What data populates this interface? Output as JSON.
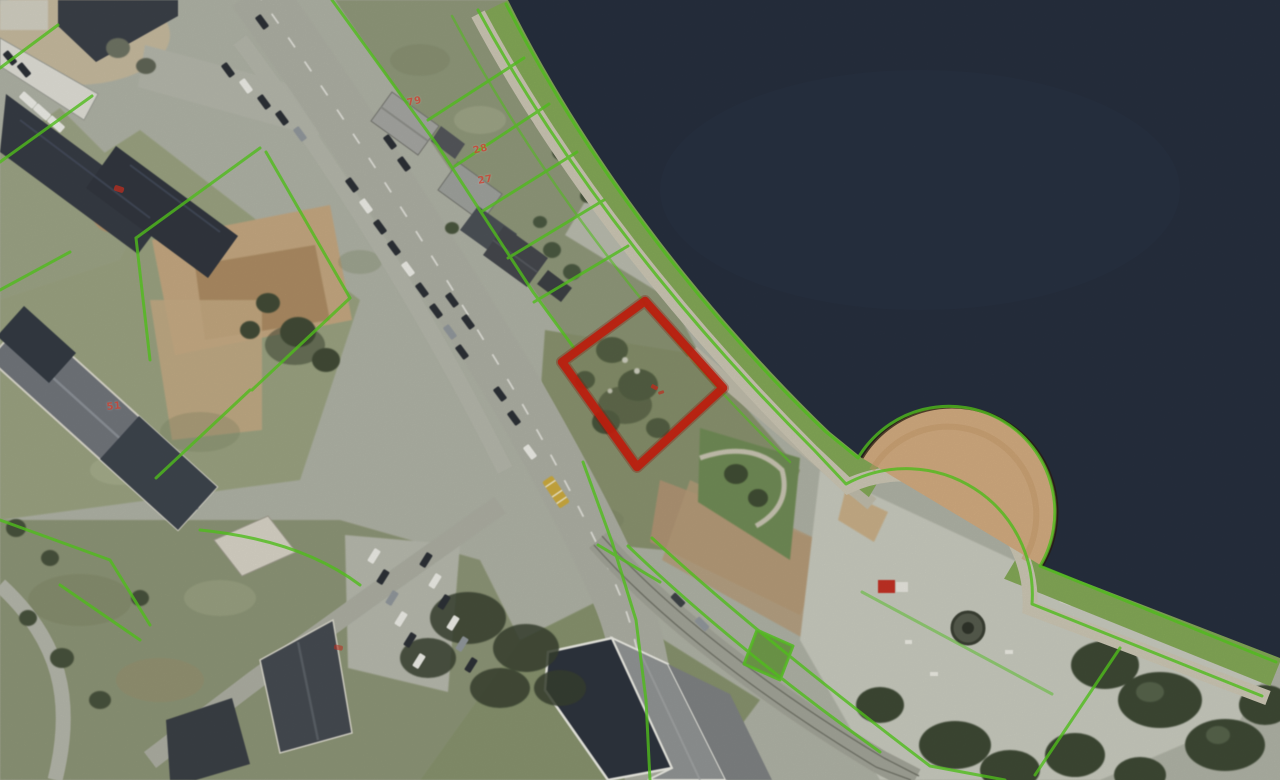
{
  "map": {
    "kind": "aerial-orthophoto-with-cadastral-overlay",
    "house_number_labels": [
      {
        "text": "79"
      },
      {
        "text": "28"
      },
      {
        "text": "27"
      },
      {
        "text": "51"
      }
    ],
    "overlay": {
      "boundary_line_color": "#55c81e",
      "highlight_parcel_color": "#c81f0e",
      "label_color": "#cf4434",
      "water_color": "#262e3d",
      "beach_color": "#cfa97e"
    }
  }
}
